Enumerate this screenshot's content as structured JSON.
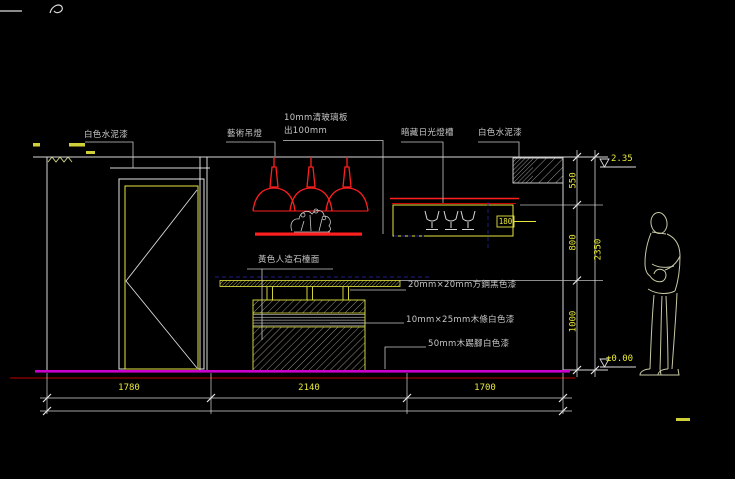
{
  "drawing": {
    "type": "interior-elevation-cad-drawing",
    "labels": {
      "wall_paint_left": "白色水泥漆",
      "art_pendant": "藝術吊燈",
      "glass_shelf_1": "10mm清玻璃板",
      "glass_shelf_2": "出100mm",
      "light_trough": "暗藏日光燈槽",
      "wall_paint_right": "白色水泥漆",
      "countertop": "黃色人造石檯面",
      "steel_tube": "20mm×20mm方鋼黑色漆",
      "wood_strip": "10mm×25mm木條白色漆",
      "skirting": "50mm木踢腳白色漆"
    },
    "dims": {
      "h": [
        "1780",
        "2140",
        "1700"
      ],
      "v": [
        "550",
        "800",
        "1000"
      ],
      "v_total": "2350",
      "trough_depth": "180",
      "level_top": "2.35",
      "level_floor": "±0.00"
    },
    "colors": {
      "background": "#000000",
      "line_white": "#d9d9d9",
      "accent_yellow": "#e9e93a",
      "lamp_red": "#ff1f1f",
      "floor_magenta": "#cc00cc",
      "baseline_dark_red": "#7d0000",
      "aux_blue": "#20208c"
    }
  }
}
